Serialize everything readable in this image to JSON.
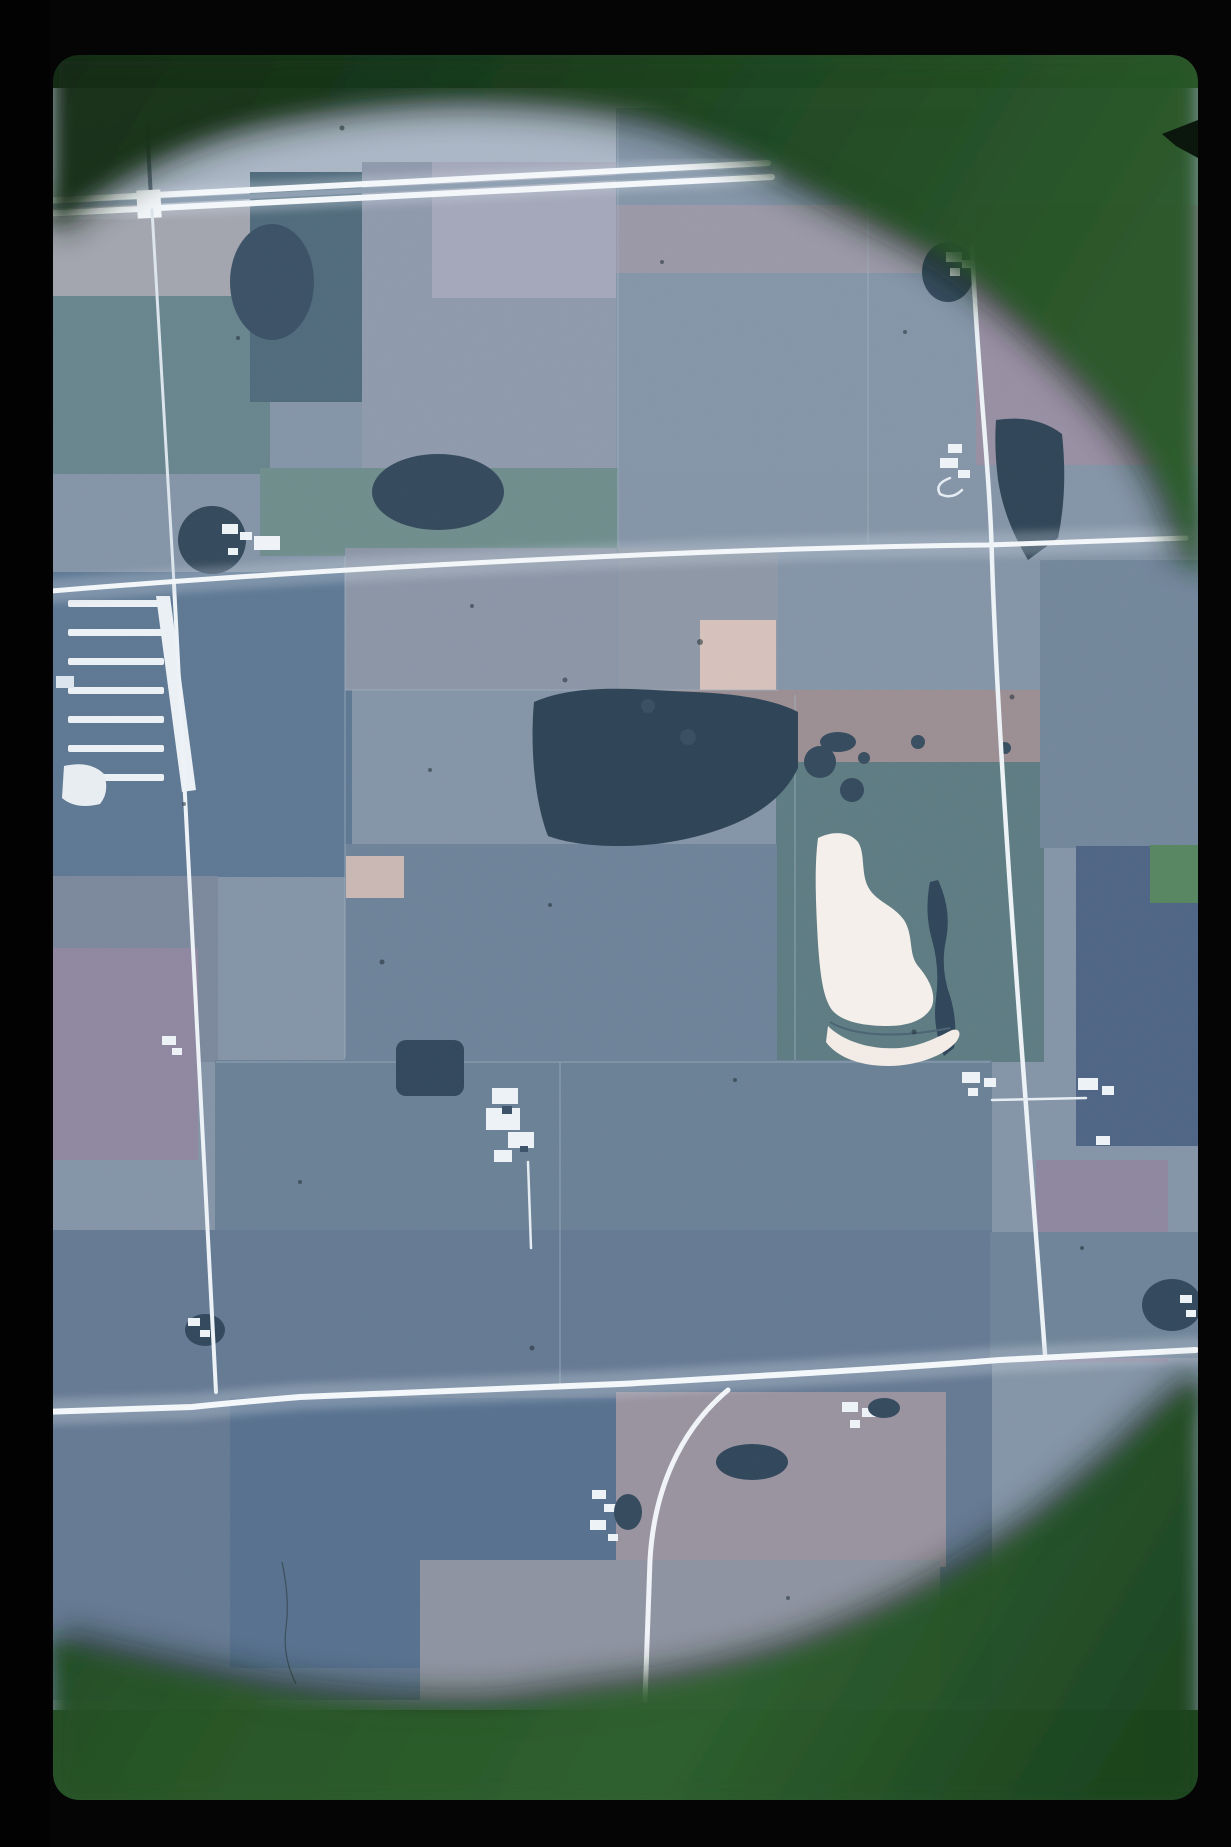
{
  "scene": {
    "type": "aerial-photograph-slide",
    "title": "35mm color slide: vertical aerial photograph of Midwestern farmland",
    "description": "A scanned color transparency in a dark green slide mount. The circular illuminated area shows a one-mile grid of white gravel section roads, rectangular crop fields in blue-gray, lavender and teal tones, a divided highway crossing the top, a dark wooded band across the center, a bright white sand and gravel pit with a crescent spoil bank, a cattle feedlot of white pen rows at left, and scattered farmsteads with white buildings.",
    "orientation": "portrait",
    "visible_text": ""
  },
  "slide": {
    "frame_color": "#050505",
    "mount_color_dark": "#122b15",
    "mount_color_mid": "#2a5829",
    "mount_color_bright": "#2e5f2f",
    "vignette_ring_color": "#0a1a10",
    "notch": "small dark chevron on the right mount edge near the top"
  },
  "photo": {
    "palette": {
      "field_base": "#8494a7",
      "field_light": "#aab6c5",
      "field_teal": "#67848c",
      "field_lavender": "#a3a7b9",
      "field_purple_gray": "#978ea2",
      "field_dark_blue": "#5d7792",
      "field_navy": "#4e6484",
      "field_tan": "#d7c2bb",
      "forest_dark": "#2c4255",
      "road_white": "#f3f7fa",
      "pit_white": "#f5f0eb",
      "farm_building_white": "#eef3f7"
    },
    "features": {
      "divided_highway": "two parallel bright white lines crossing the top of the photo, rising slightly to the right",
      "mid_section_road": "white east-west road across the middle third, y rising from left to right",
      "bottom_section_road": "bright east-west road across the lower third with a curved branch turning south",
      "left_north_south_road": "faint road slanting from the highway down to the lower-left junction",
      "right_north_south_road": "white road down the right half linking three farmstead clusters",
      "feedlot": "six white pen rows with an angled white alley, left of center",
      "sand_pit": "irregular bright white excavation with a detached crescent spoil bank, right of center",
      "forest_band": "dark deciduous woodland strip across the center",
      "tan_fields": [
        "small bare square near center",
        "larger bare rectangle right of center"
      ],
      "farmstead_count": 9,
      "dust_specks": "scattered dark specks and a fine hair on the emulsion"
    }
  }
}
